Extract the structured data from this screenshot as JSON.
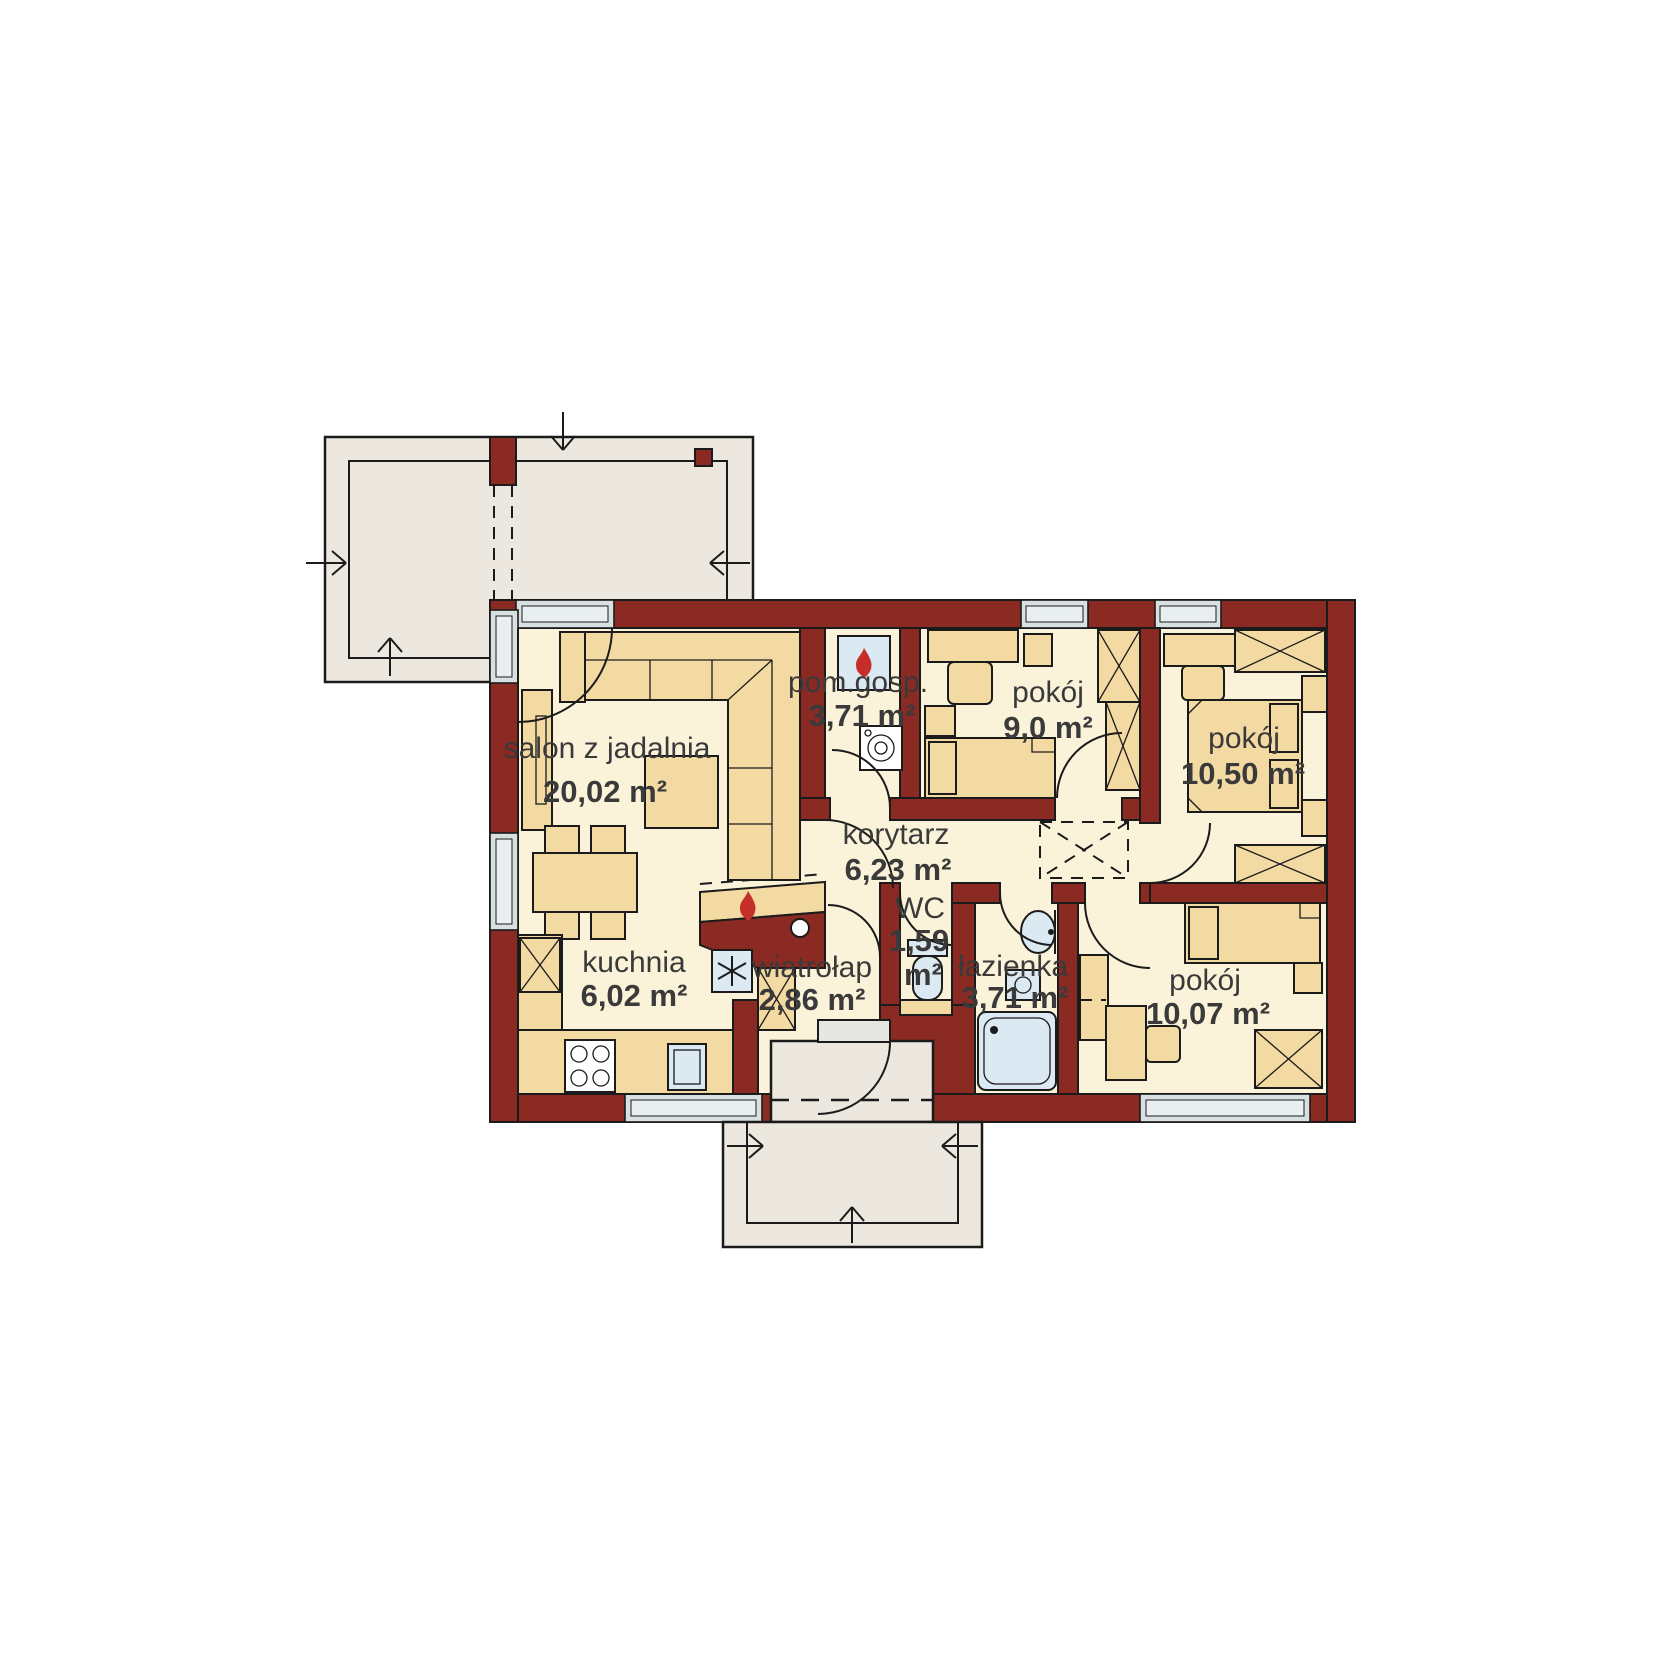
{
  "plan_type": "floor-plan",
  "rooms": [
    {
      "id": "salon",
      "name": "salon z jadalnia",
      "area": "20,02 m²"
    },
    {
      "id": "pom_gosp",
      "name": "pom.gosp.",
      "area": "3,71 m²"
    },
    {
      "id": "pokoj_9",
      "name": "pokój",
      "area": "9,0 m²"
    },
    {
      "id": "pokoj_1050",
      "name": "pokój",
      "area": "10,50 m²"
    },
    {
      "id": "korytarz",
      "name": "korytarz",
      "area": "6,23 m²"
    },
    {
      "id": "wc",
      "name": "WC",
      "area_value": "1,59",
      "area_unit": "m²"
    },
    {
      "id": "wiatrolap",
      "name": "wiatrołap",
      "area": "2,86 m²"
    },
    {
      "id": "lazienka",
      "name": "łazienka",
      "area": "3,71 m²"
    },
    {
      "id": "pokoj_1007",
      "name": "pokój",
      "area": "10,07 m²"
    },
    {
      "id": "kuchnia",
      "name": "kuchnia",
      "area": "6,02 m²"
    }
  ],
  "colors": {
    "wall": "#8a2a23",
    "floor": "#fbf3d9",
    "furniture": "#f3d9a2",
    "glass": "#d8e0e2",
    "glass_light": "#e9eef0",
    "fixture": "#dbe9f3",
    "terrace": "#ece8df",
    "outline": "#1b1b1b",
    "label": "#3a3a3a",
    "flame": "#c62f29",
    "white": "#ffffff"
  }
}
